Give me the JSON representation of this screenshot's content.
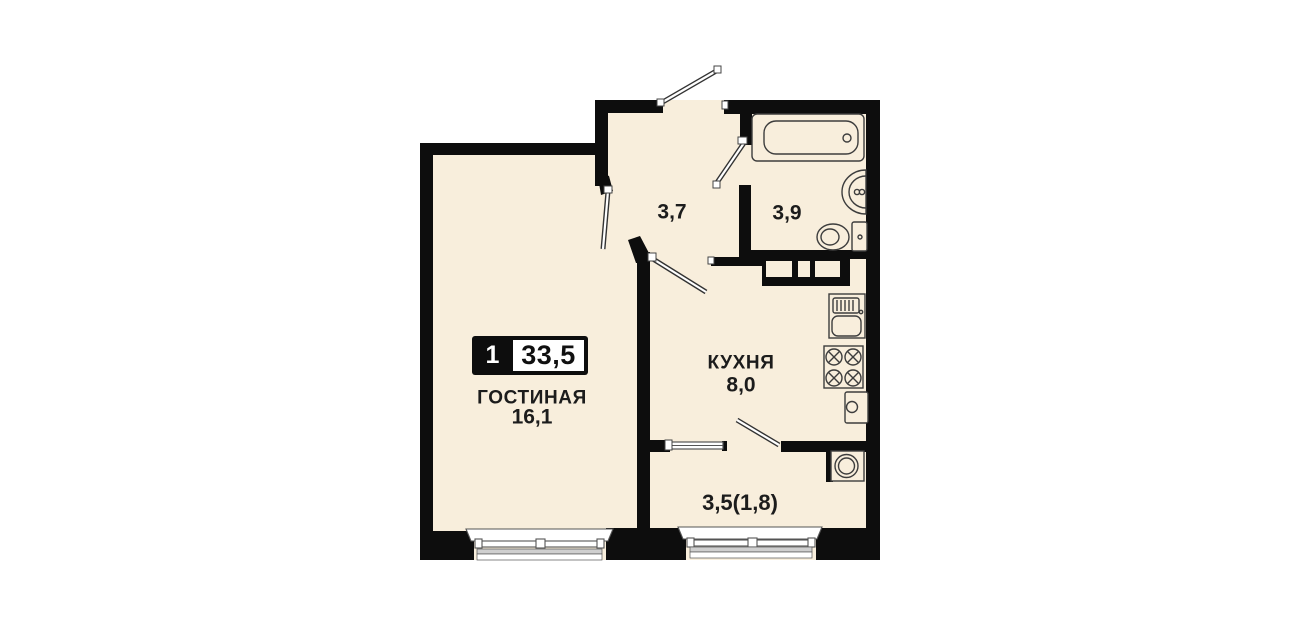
{
  "canvas": {
    "width": 1301,
    "height": 630,
    "background": "#ffffff"
  },
  "plan": {
    "colors": {
      "floor": "#f8eedc",
      "wall": "#0d0d0d",
      "fixture_line": "#3d3d3d",
      "window_gray": "#cfcfcf",
      "badge_bg": "#0d0d0d",
      "badge_box": "#ffffff"
    },
    "badge": {
      "rooms_count": "1",
      "total_area": "33,5"
    },
    "rooms": {
      "living": {
        "name": "ГОСТИНАЯ",
        "area": "16,1"
      },
      "kitchen": {
        "name": "КУХНЯ",
        "area": "8,0"
      },
      "hallway": {
        "area": "3,7"
      },
      "bathroom": {
        "area": "3,9"
      },
      "balcony": {
        "area": "3,5(1,8)"
      }
    },
    "icons": [
      "bathtub-icon",
      "sink-icon",
      "toilet-icon",
      "wardrobe-icon",
      "kitchen-sink-icon",
      "stove-icon",
      "water-heater-icon",
      "washing-machine-icon",
      "entrance-door-icon",
      "living-door-icon",
      "kitchen-door-icon",
      "bathroom-door-icon",
      "balcony-door-icon",
      "window-icon"
    ]
  }
}
